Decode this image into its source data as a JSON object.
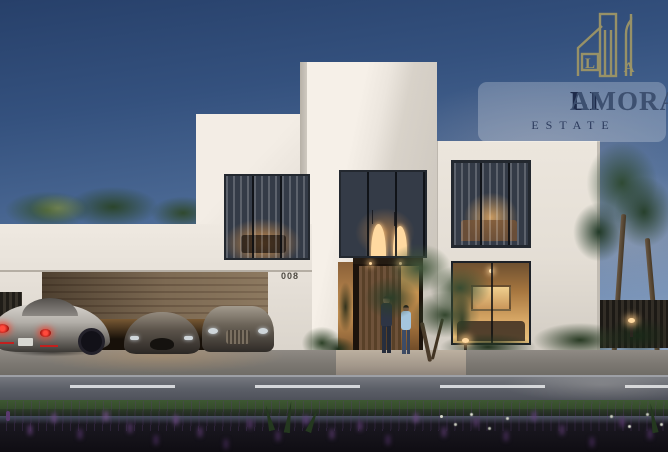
{
  "brand": {
    "name": "LIAMORA",
    "name_primary": "LI",
    "name_secondary": "AMORA",
    "tagline": "ESTATE",
    "icon": "skyline-buildings-icon",
    "icon_color": "#9d9566",
    "name_color_primary": "#1d2a4a",
    "name_color_secondary": "#3d5070"
  },
  "villa": {
    "house_number": "008"
  },
  "scene": {
    "time_of_day": "dusk",
    "elements": [
      "dusk-sky",
      "palm-trees",
      "white-modern-villa",
      "lit-interior-windows",
      "garage-with-three-luxury-cars",
      "entrance-with-two-people",
      "olive-tree",
      "garden-hedges",
      "street-with-lane-markings",
      "purple-flower-bed"
    ]
  },
  "palette": {
    "sky_top": "#27406a",
    "sky_bottom": "#a9bcd2",
    "facade_light": "#f6f0e8",
    "facade_shade": "#c8c2b9",
    "interior_glow": "#e0a860",
    "garage_door": "#77644d",
    "road": "#5c5f68",
    "grass": "#33492b",
    "flowers": "#5a3a6e"
  }
}
